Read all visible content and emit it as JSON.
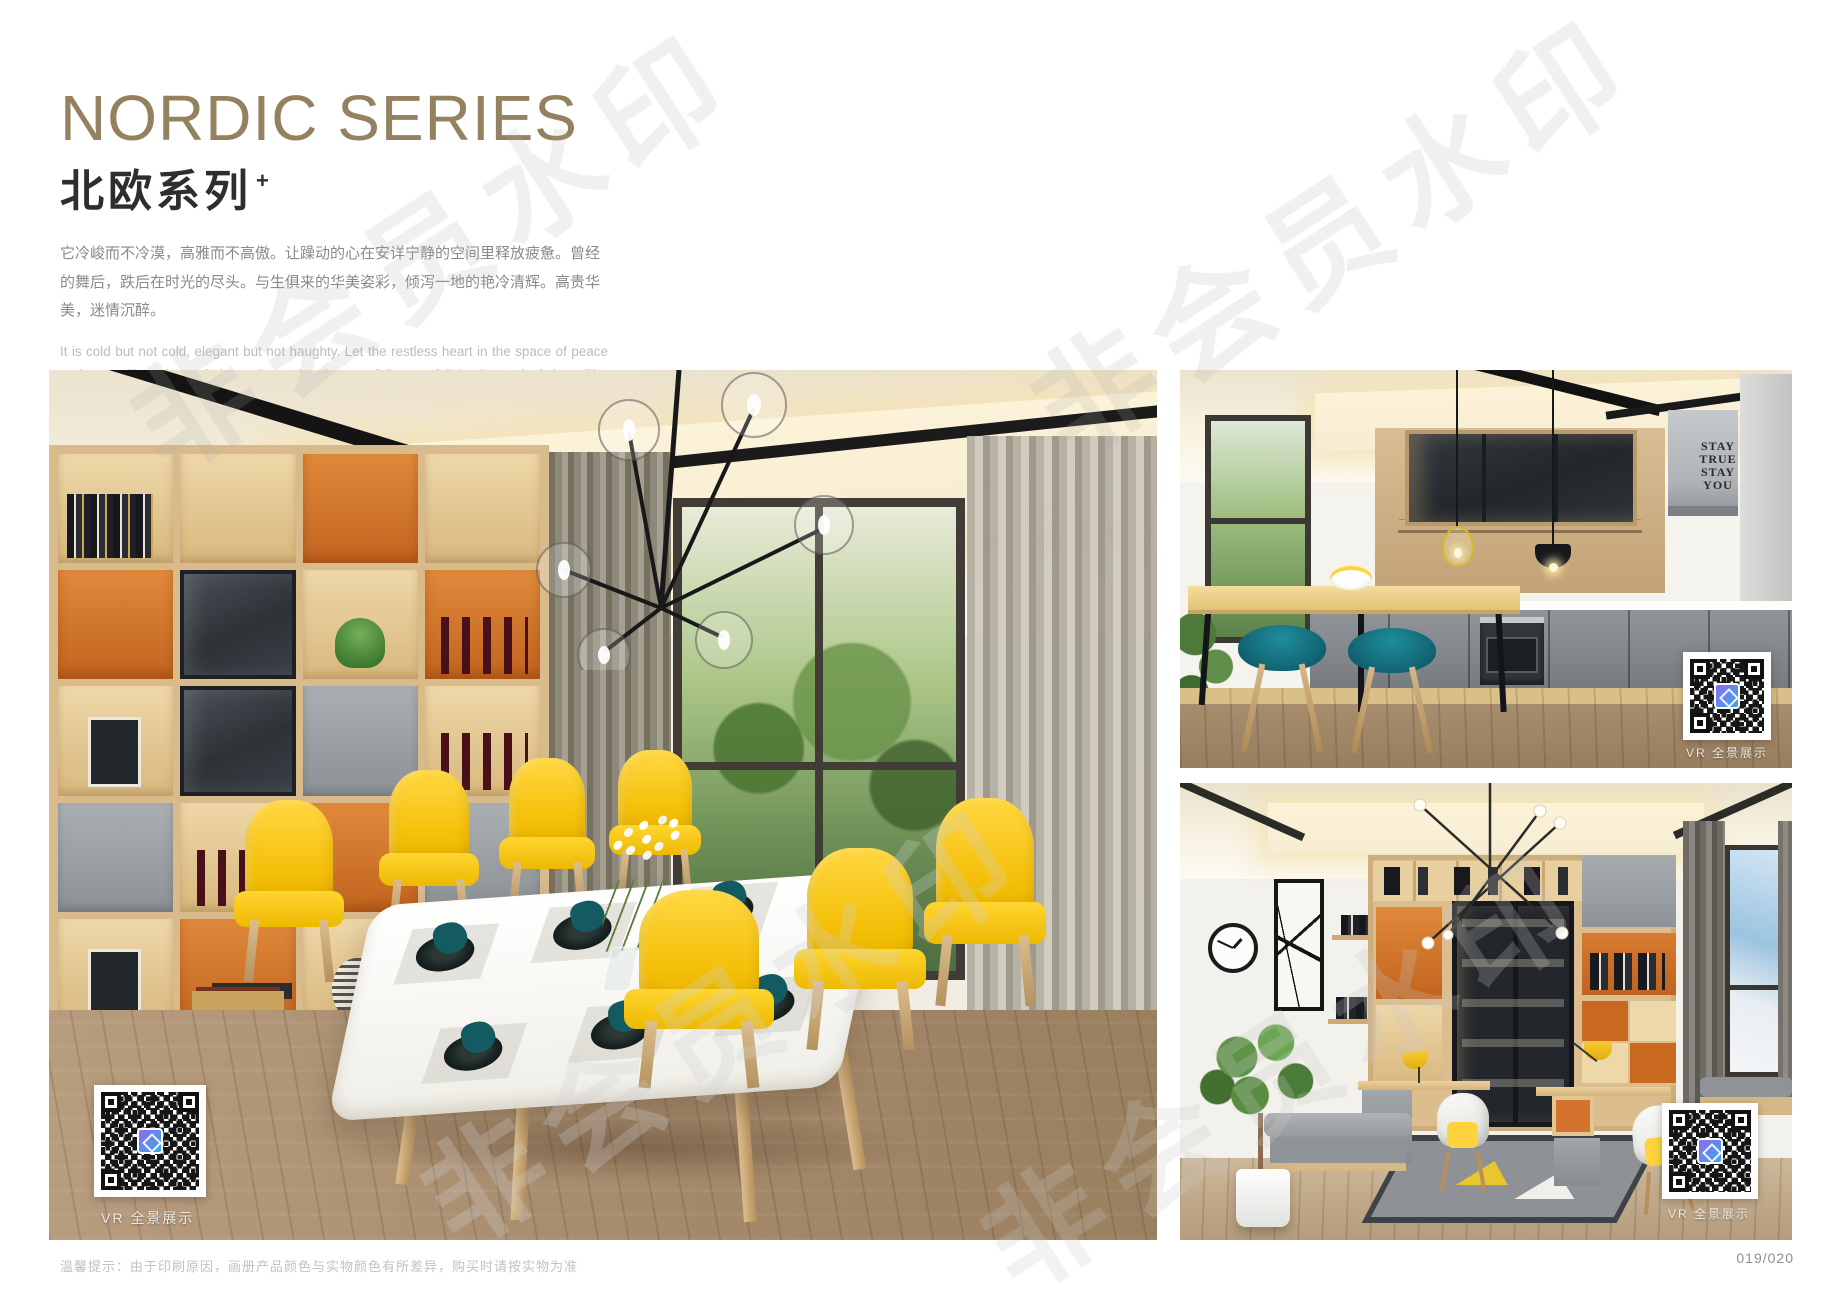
{
  "page": {
    "title_en": "NORDIC SERIES",
    "title_zh": "北欧系列",
    "title_plus": "+",
    "desc_zh": "它冷峻而不冷漠，高雅而不高傲。让躁动的心在安详宁静的空间里释放疲惫。曾经的舞后，跌后在时光的尽头。与生俱来的华美姿彩，倾泻一地的艳冷清辉。高贵华美，迷情沉醉。",
    "desc_en": "It is cold but not cold, elegant but not haughty. Let the restless heart in the space of peace and tranquility release fatigue. Once the Queen of Dance, fall in the end of time. The natural beauty of the beautiful, pouring a land of cold and pure brilliance. Noble, beautiful, enchanted.",
    "watermark": "非会员水印",
    "footer_note": "温馨提示：由于印刷原因，画册产品颜色与实物颜色有所差异，购买时请按实物为准",
    "page_number": "019/020"
  },
  "images": {
    "main": {
      "name": "dining-room",
      "vr_label": "VR 全景展示"
    },
    "kitchen": {
      "name": "kitchen-bar",
      "vr_label": "VR 全景展示",
      "wall_text": [
        "STAY",
        "TRUE",
        "STAY",
        "YOU"
      ]
    },
    "study": {
      "name": "study-room",
      "vr_label": "VR 全景展示"
    }
  },
  "colors": {
    "title": "#94815f",
    "accent_orange": "#d4732e",
    "chair_yellow": "#f7c600",
    "stool_teal": "#1b7c8d",
    "wood": "#d9ba8a"
  }
}
